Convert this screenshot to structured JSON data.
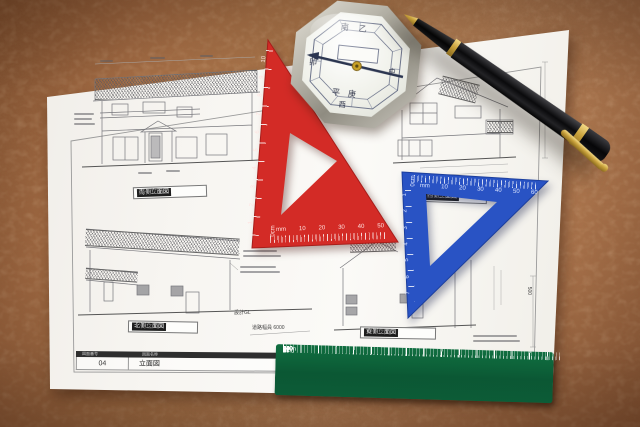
{
  "sheet": {
    "labels": [
      {
        "name": "南側立面図",
        "scale": "1/100"
      },
      {
        "name": "西側立面図",
        "scale": "1/100"
      },
      {
        "name": "北側立面図",
        "scale": "1/100"
      },
      {
        "name": "東側立面図",
        "scale": "1/100"
      }
    ],
    "title_block": {
      "header_number": "図面番号",
      "header_name": "図面名称",
      "number": "04",
      "name": "立面図"
    },
    "annotations": {
      "road_width": "道路幅員 6000",
      "gl": "設計GL",
      "dim_500": "500"
    }
  },
  "red_triangle": {
    "zero_label": "0cm",
    "unit_label": "mm",
    "bottom_numbers": [
      "mm",
      "10",
      "20",
      "30",
      "40",
      "50"
    ],
    "side_numbers": [
      "10",
      "9",
      "8",
      "7",
      "6",
      "5",
      "4",
      "3",
      "2",
      "1"
    ],
    "color": "#d32b26"
  },
  "blue_triangle": {
    "zero_label": "0cm",
    "top_numbers": [
      "mm",
      "10",
      "20",
      "30",
      "40",
      "50",
      "60"
    ],
    "side_numbers": [
      "1",
      "2",
      "3",
      "4",
      "5",
      "6",
      "7"
    ],
    "color": "#2953c4"
  },
  "green_ruler": {
    "top_numbers": [
      "0mm",
      "10",
      "20",
      "30",
      "40",
      "50",
      "60",
      "70",
      "80",
      "90",
      "100",
      "110",
      "120",
      "130",
      "140",
      "150"
    ],
    "bottom_numbers": [
      "15",
      "14",
      "13",
      "12",
      "11",
      "10",
      "9",
      "8",
      "7",
      "6",
      "5",
      "4",
      "3",
      "2",
      "1",
      "0cm"
    ],
    "color": "#0d5c36"
  },
  "compass": {
    "kanji": {
      "top1": "南",
      "top2": "乙",
      "left": "卯",
      "mid": "中",
      "bot1": "平",
      "bot2": "庚",
      "bot3": "西"
    }
  },
  "colors": {
    "cork": "#a96f46",
    "paper": "#f7f5f1",
    "pen": "#0a0a0c",
    "gold": "#c9a23c"
  }
}
